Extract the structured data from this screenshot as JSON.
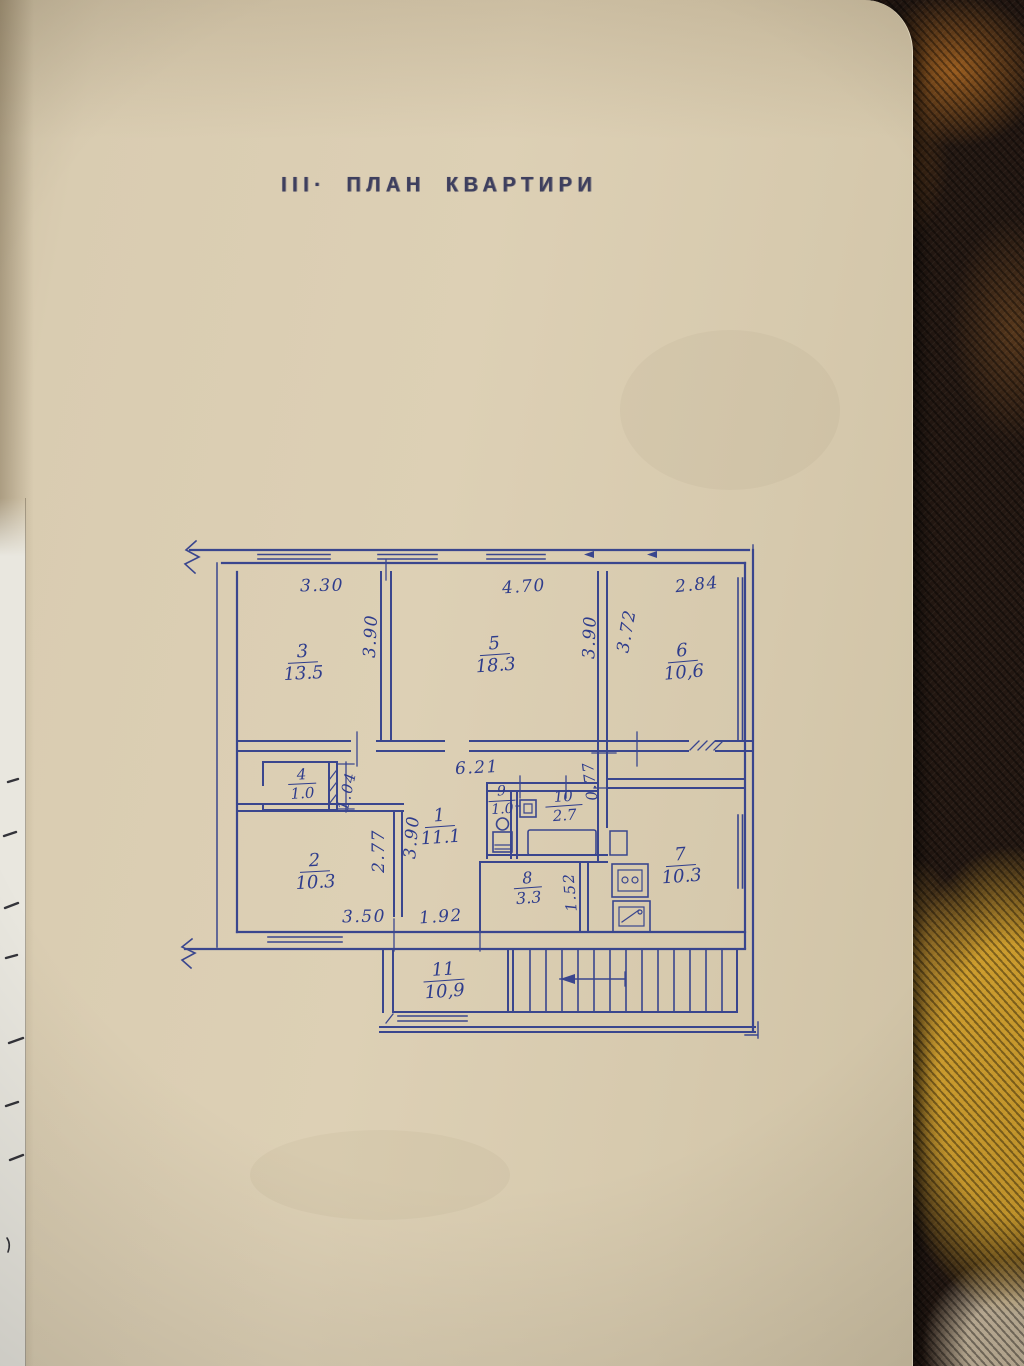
{
  "page": {
    "title": "ІІІ· ПЛАН  КВАРТИРИ"
  },
  "colors": {
    "paper": "#d9ccb1",
    "plan_ink": "#2e3c8c",
    "title_ink": "#3e3f5e",
    "carpet_dark": "#241812",
    "carpet_gold": "#cf9e2d",
    "carpet_orange": "#ad6822",
    "under_sheet": "#e9e7df"
  },
  "floor_plan": {
    "rooms": [
      {
        "number": "3",
        "area": "13.5"
      },
      {
        "number": "5",
        "area": "18.3"
      },
      {
        "number": "6",
        "area": "10,6"
      },
      {
        "number": "4",
        "area": "1.0"
      },
      {
        "number": "1",
        "area": "11.1"
      },
      {
        "number": "9",
        "area": "1.0"
      },
      {
        "number": "10",
        "area": "2.7"
      },
      {
        "number": "7",
        "area": "10.3"
      },
      {
        "number": "2",
        "area": "10.3"
      },
      {
        "number": "8",
        "area": "3.3"
      },
      {
        "number": "11",
        "area": "10,9"
      }
    ],
    "dimensions": [
      {
        "value": "3.30"
      },
      {
        "value": "4.70"
      },
      {
        "value": "2.84"
      },
      {
        "value": "3.90"
      },
      {
        "value": "3.90"
      },
      {
        "value": "3.72"
      },
      {
        "value": "6.21"
      },
      {
        "value": "1.04"
      },
      {
        "value": "0.77"
      },
      {
        "value": "2.77"
      },
      {
        "value": "3.90"
      },
      {
        "value": "1.52"
      },
      {
        "value": "3.50"
      },
      {
        "value": "1.92"
      }
    ]
  }
}
